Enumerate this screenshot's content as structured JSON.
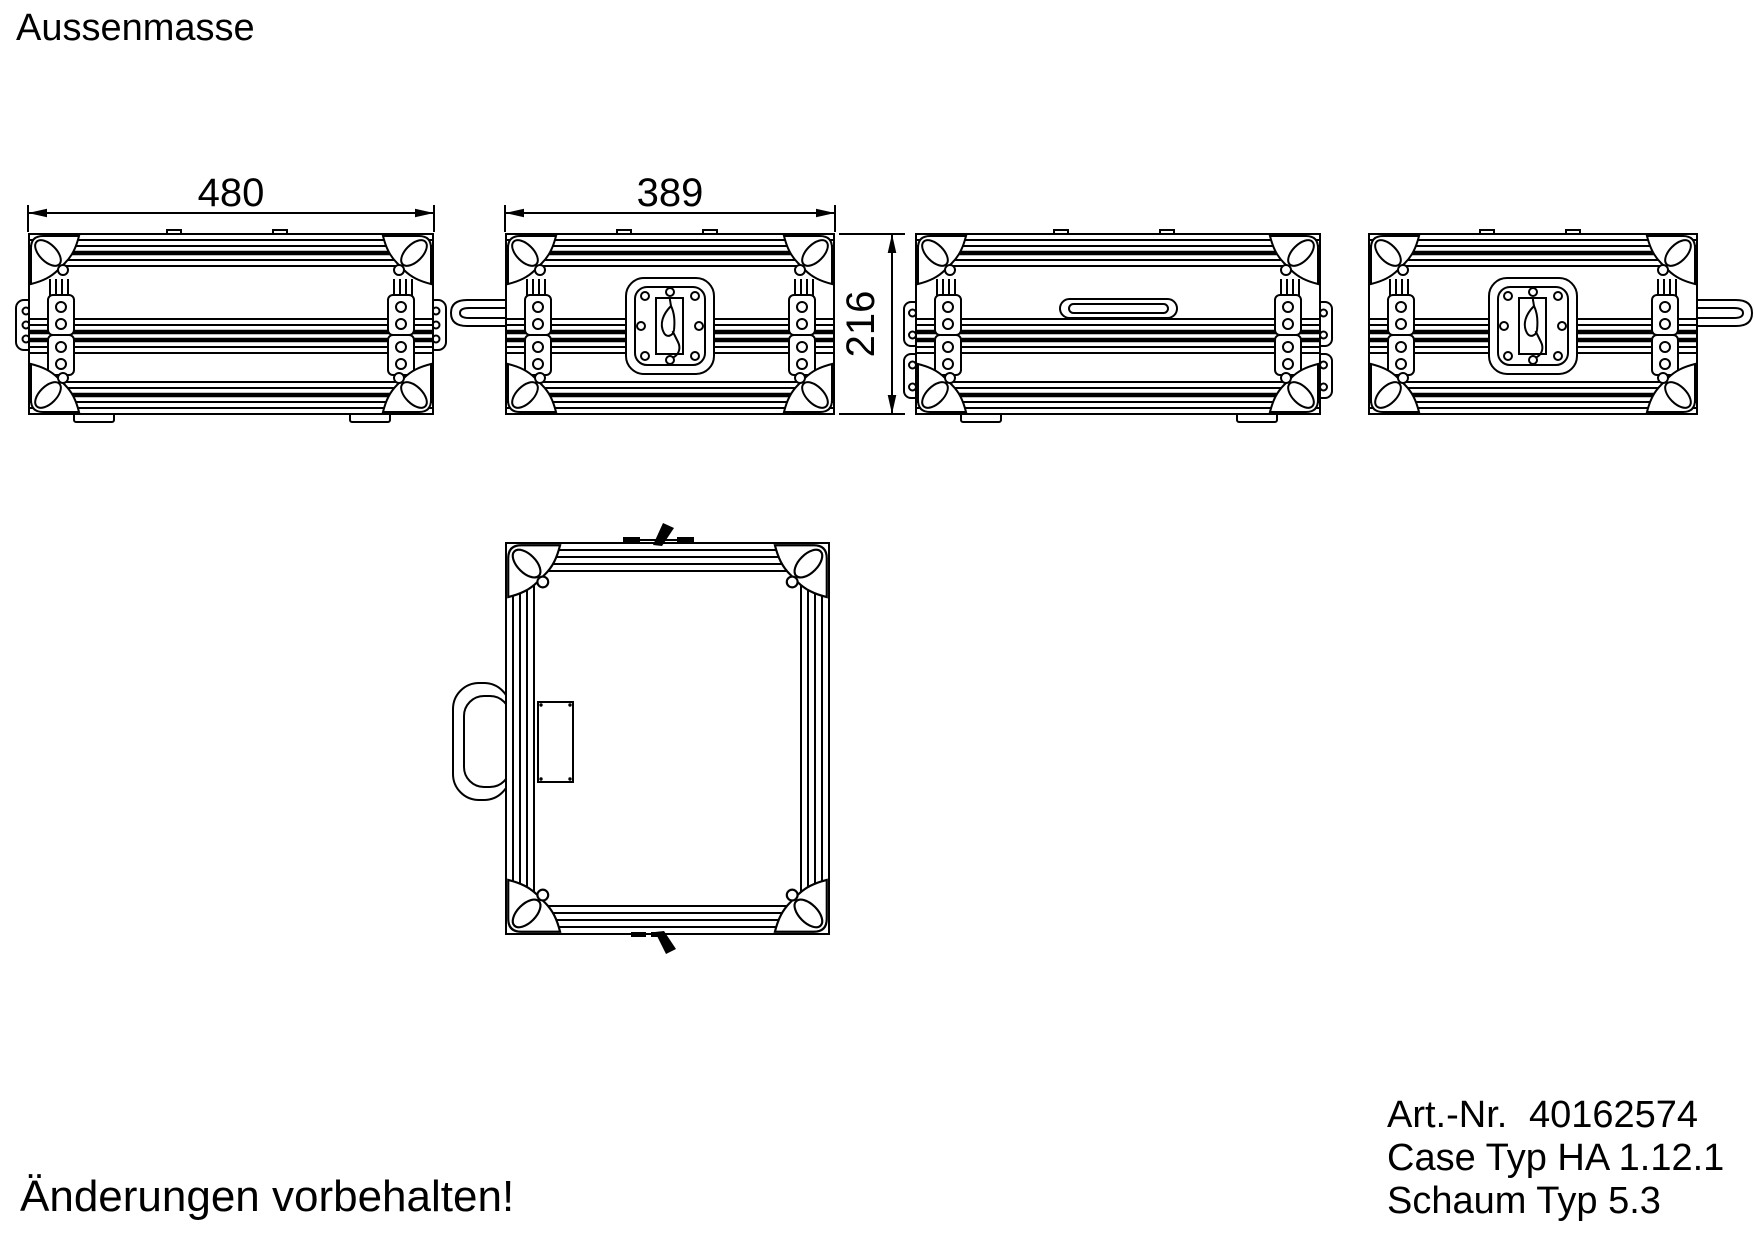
{
  "page": {
    "title": "Aussenmasse",
    "note": "Änderungen vorbehalten!"
  },
  "info": {
    "art_label": "Art.-Nr.",
    "art_value": "40162574",
    "case_type": "Case Typ HA 1.12.1",
    "foam_type": "Schaum Typ 5.3"
  },
  "dims": {
    "front_width": "480",
    "side_width": "389",
    "height": "216"
  }
}
